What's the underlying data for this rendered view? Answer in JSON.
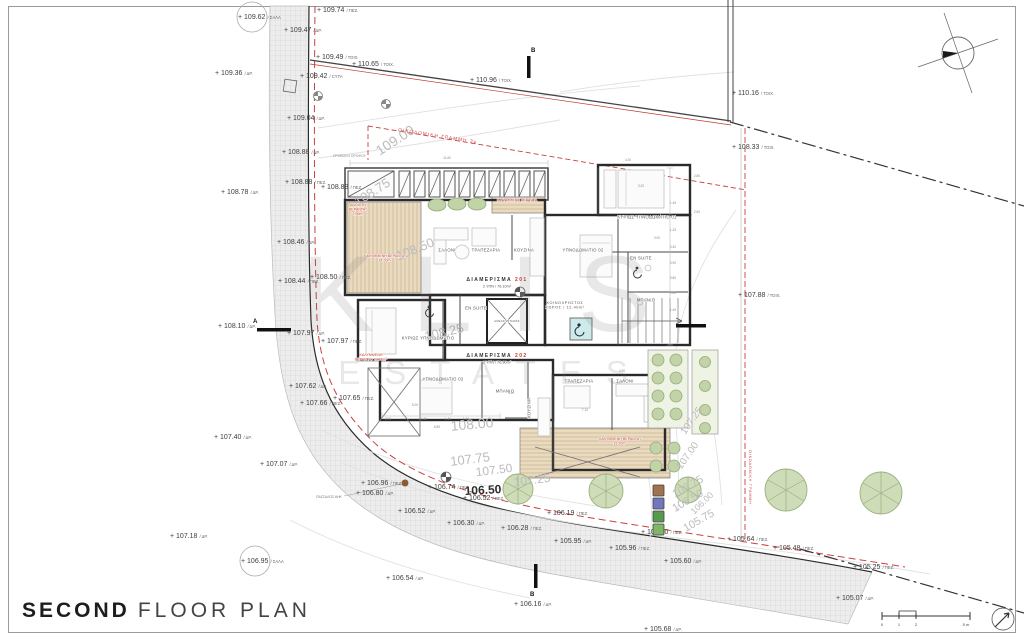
{
  "title": {
    "bold": "SECOND",
    "rest": "FLOOR PLAN"
  },
  "watermark": {
    "line1": "KLIS",
    "line2": "ESTATES"
  },
  "site_labels": {
    "building_line_top": "ΟΙΚΟΔΟΜΙΚΗ ΓΡΑΜΜΗ 3μ",
    "building_line_right": "ΟΙΚΟΔΟΜΙΚΗ ΓΡΑΜΜΗ",
    "floor_projection": "ΠΡΟΒΟΛΗ ΟΡΟΦΟΥ",
    "pole": "ΠΑΣΣΑΛΟΣ ΑΗΚ"
  },
  "apartments": [
    {
      "name": "ΔΙΑΜΕΡΙΣΜΑ",
      "number": "201",
      "info": "2 ΥΠΝ / 76.10m²",
      "x": 497,
      "y": 281
    },
    {
      "name": "ΔΙΑΜΕΡΙΣΜΑ",
      "number": "202",
      "info": "2 ΥΠΝ / 76.80m²",
      "x": 497,
      "y": 357
    }
  ],
  "common_area": {
    "lines": [
      "ΚΟΙΝΟΧΡΗΣΤΟΣ",
      "ΧΩΡΟΣ / 12.40m²"
    ],
    "x": 565,
    "y": 304
  },
  "rooms": [
    {
      "label": "ΣΑΛΟΝΙ",
      "x": 447,
      "y": 250
    },
    {
      "label": "ΤΡΑΠΕΖΑΡΙΑ",
      "x": 486,
      "y": 250
    },
    {
      "label": "ΚΟΥΖΙΝΑ",
      "x": 524,
      "y": 250
    },
    {
      "label": "ΥΠΝΟΔΩΜΑΤΙΟ 02",
      "x": 583,
      "y": 250
    },
    {
      "label": "ΚΥΡΙΩΣ ΥΠΝΟΔΩΜΑΤΙΟ 01",
      "x": 647,
      "y": 217
    },
    {
      "label": "EN SUITE",
      "x": 641,
      "y": 258
    },
    {
      "label": "ΜΠΑΝΙΟ",
      "x": 646,
      "y": 300
    },
    {
      "label": "EN SUITE",
      "x": 476,
      "y": 308
    },
    {
      "label": "ΑΝΕΛΚΥΣΤΗΡΑΣ",
      "x": 507,
      "y": 321,
      "size": 2.8
    },
    {
      "label": "ΚΥΡΙΩΣ ΥΠΝΟΔΩΜΑΤΙΟ",
      "x": 428,
      "y": 338
    },
    {
      "label": "ΥΠΝΟΔΩΜΑΤΙΟ 02",
      "x": 443,
      "y": 379
    },
    {
      "label": "ΜΠΑΝΙΟ",
      "x": 505,
      "y": 391
    },
    {
      "label": "ΚΟΥΖΙΝΑ",
      "x": 529,
      "y": 408,
      "rot": -90
    },
    {
      "label": "ΤΡΑΠΕΖΑΡΙΑ",
      "x": 579,
      "y": 381
    },
    {
      "label": "ΣΑΛΟΝΙ",
      "x": 625,
      "y": 381
    }
  ],
  "red_areas": [
    {
      "lines": [
        "ΑΝΟΙΧΤΗ",
        "ΒΕΡΑΝΤΑ /",
        "7.90m²"
      ],
      "x": 358,
      "y": 206
    },
    {
      "lines": [
        "ΚΑΛΥΜΜΕΝΗ ΒΕΡΑΝΤΑ /",
        "14.20m²"
      ],
      "x": 385,
      "y": 257
    },
    {
      "lines": [
        "ΚΑΛΥΜΜΕΝΗ ΒΕΡΑΝΤΑ"
      ],
      "x": 517,
      "y": 201
    },
    {
      "lines": [
        "ΚΑΛΥΜΜΕΝΗ",
        "ΒΕΡΑΝΤΑ / 21.60m²"
      ],
      "x": 371,
      "y": 356
    },
    {
      "lines": [
        "ΚΑΛΥΜΜΕΝΗ ΒΕΡΑΝΤΑ /",
        "19.20m²"
      ],
      "x": 620,
      "y": 440
    }
  ],
  "elevations": [
    {
      "v": "+ 109.62",
      "s": "ΣΑΛΑ",
      "x": 238,
      "y": 17,
      "circle": true
    },
    {
      "v": "+ 109.74",
      "s": "ΠΕΖ.",
      "x": 317,
      "y": 10
    },
    {
      "v": "+ 109.47",
      "s": "ΔΡ.",
      "x": 284,
      "y": 30
    },
    {
      "v": "+ 109.49",
      "s": "ΤΟΙΧ.",
      "x": 316,
      "y": 57
    },
    {
      "v": "+ 110.65",
      "s": "ΤΟΙΧ.",
      "x": 352,
      "y": 64
    },
    {
      "v": "+ 109.36",
      "s": "ΔΡ.",
      "x": 215,
      "y": 73
    },
    {
      "v": "+ 109.42",
      "s": "CYTA",
      "x": 300,
      "y": 76
    },
    {
      "v": "+ 110.96",
      "s": "ΤΟΙΧ.",
      "x": 470,
      "y": 80
    },
    {
      "v": "+ 110.16",
      "s": "ΤΟΙΧ.",
      "x": 732,
      "y": 93
    },
    {
      "v": "+ 109.04",
      "s": "ΔΡ.",
      "x": 287,
      "y": 118
    },
    {
      "v": "+ 108.33",
      "s": "ΤΟΙΧ.",
      "x": 732,
      "y": 147
    },
    {
      "v": "+ 108.88",
      "s": "ΔΡ.",
      "x": 282,
      "y": 152
    },
    {
      "v": "+ 108.88",
      "s": "ΠΕΖ.",
      "x": 285,
      "y": 182
    },
    {
      "v": "+ 108.88",
      "s": "ΠΕΖ.",
      "x": 321,
      "y": 187
    },
    {
      "v": "+ 108.78",
      "s": "ΔΡ.",
      "x": 221,
      "y": 192
    },
    {
      "v": "+ 108.46",
      "s": "ΔΡ.",
      "x": 277,
      "y": 242
    },
    {
      "v": "+ 108.50",
      "s": "ΠΕΖ.",
      "x": 310,
      "y": 277
    },
    {
      "v": "+ 108.44",
      "s": "ΠΕΖ.",
      "x": 278,
      "y": 281
    },
    {
      "v": "+ 107.88",
      "s": "ΤΟΙΧ.",
      "x": 738,
      "y": 295
    },
    {
      "v": "+ 108.10",
      "s": "ΔΡ.",
      "x": 218,
      "y": 326
    },
    {
      "v": "+ 107.97",
      "s": "ΔΡ.",
      "x": 287,
      "y": 333
    },
    {
      "v": "+ 107.97",
      "s": "ΠΕΖ.",
      "x": 321,
      "y": 341
    },
    {
      "v": "+ 107.62",
      "s": "ΔΡ.",
      "x": 289,
      "y": 386
    },
    {
      "v": "+ 107.65",
      "s": "ΠΕΖ.",
      "x": 333,
      "y": 398
    },
    {
      "v": "+ 107.66",
      "s": "ΠΕΖ.",
      "x": 300,
      "y": 403
    },
    {
      "v": "+ 107.40",
      "s": "ΔΡ.",
      "x": 214,
      "y": 437
    },
    {
      "v": "+ 107.07",
      "s": "ΔΡ.",
      "x": 260,
      "y": 464
    },
    {
      "v": "+ 106.96",
      "s": "ΠΕΖ.",
      "x": 361,
      "y": 483
    },
    {
      "v": "+ 106.80",
      "s": "ΔΡ.",
      "x": 356,
      "y": 493
    },
    {
      "v": "+ 106.74",
      "s": "ΠΕΖ.",
      "x": 428,
      "y": 487
    },
    {
      "v": "+ 106.52",
      "s": "ΠΕΖ.",
      "x": 463,
      "y": 498
    },
    {
      "v": "+ 106.52",
      "s": "ΔΡ.",
      "x": 398,
      "y": 511
    },
    {
      "v": "+ 106.30",
      "s": "ΔΡ.",
      "x": 447,
      "y": 523
    },
    {
      "v": "+ 106.28",
      "s": "ΠΕΖ.",
      "x": 501,
      "y": 528
    },
    {
      "v": "+ 106.19",
      "s": "ΠΕΖ.",
      "x": 547,
      "y": 513
    },
    {
      "v": "+ 107.18",
      "s": "ΔΡ.",
      "x": 170,
      "y": 536
    },
    {
      "v": "+ 106.95",
      "s": "ΣΑΛΑ",
      "x": 241,
      "y": 561,
      "circle": true
    },
    {
      "v": "+ 105.95",
      "s": "ΔΡ.",
      "x": 554,
      "y": 541
    },
    {
      "v": "+ 105.96",
      "s": "ΠΕΖ.",
      "x": 609,
      "y": 548
    },
    {
      "v": "+ 105.90",
      "s": "ΠΕΖ.",
      "x": 641,
      "y": 532
    },
    {
      "v": "+ 106.54",
      "s": "ΔΡ.",
      "x": 386,
      "y": 578
    },
    {
      "v": "+ 105.60",
      "s": "ΔΡ.",
      "x": 664,
      "y": 561
    },
    {
      "v": "+ 105.64",
      "s": "ΠΕΖ.",
      "x": 727,
      "y": 539
    },
    {
      "v": "+ 105.48",
      "s": "ΠΕΖ.",
      "x": 773,
      "y": 548
    },
    {
      "v": "+ 105.25",
      "s": "ΠΕΖ.",
      "x": 853,
      "y": 567
    },
    {
      "v": "+ 105.07",
      "s": "ΔΡ.",
      "x": 836,
      "y": 598
    },
    {
      "v": "+ 106.16",
      "s": "ΔΡ.",
      "x": 514,
      "y": 604
    },
    {
      "v": "+ 105.68",
      "s": "ΔΡ.",
      "x": 644,
      "y": 629
    }
  ],
  "contours": [
    {
      "t": "109.00",
      "x": 395,
      "y": 140,
      "r": -33,
      "fs": 14
    },
    {
      "t": "108.75",
      "x": 372,
      "y": 192,
      "r": -33,
      "fs": 13
    },
    {
      "t": "108.50",
      "x": 415,
      "y": 249,
      "r": -22,
      "fs": 13
    },
    {
      "t": "108.25",
      "x": 444,
      "y": 332,
      "r": -13,
      "fs": 13
    },
    {
      "t": "108.00",
      "x": 472,
      "y": 424,
      "r": -5,
      "fs": 14
    },
    {
      "t": "107.75",
      "x": 470,
      "y": 459,
      "r": -7,
      "fs": 13
    },
    {
      "t": "107.50",
      "x": 494,
      "y": 470,
      "r": -7,
      "fs": 12
    },
    {
      "t": "107.25",
      "x": 532,
      "y": 480,
      "r": -7,
      "fs": 12
    },
    {
      "t": "106.50",
      "x": 483,
      "y": 490,
      "r": -3,
      "fs": 12,
      "bold": true
    },
    {
      "t": "107.25",
      "x": 692,
      "y": 421,
      "r": -55,
      "fs": 10
    },
    {
      "t": "107.00",
      "x": 688,
      "y": 456,
      "r": -55,
      "fs": 10
    },
    {
      "t": "106.75",
      "x": 688,
      "y": 487,
      "r": -30,
      "fs": 11
    },
    {
      "t": "106.50",
      "x": 688,
      "y": 501,
      "r": -30,
      "fs": 11
    },
    {
      "t": "106.00",
      "x": 702,
      "y": 503,
      "r": -44,
      "fs": 9
    },
    {
      "t": "105.75",
      "x": 699,
      "y": 521,
      "r": -30,
      "fs": 11
    }
  ],
  "dims": [
    {
      "t": "11.60",
      "x": 447,
      "y": 158
    },
    {
      "t": "4.30",
      "x": 628,
      "y": 160
    },
    {
      "t": "2.80",
      "x": 697,
      "y": 176
    },
    {
      "t": "2.60",
      "x": 697,
      "y": 212
    },
    {
      "t": "3.20",
      "x": 641,
      "y": 186
    },
    {
      "t": "3.00",
      "x": 657,
      "y": 238
    },
    {
      "t": "1.45",
      "x": 673,
      "y": 203
    },
    {
      "t": "1.25",
      "x": 673,
      "y": 230
    },
    {
      "t": "0.40",
      "x": 673,
      "y": 247
    },
    {
      "t": "0.90",
      "x": 673,
      "y": 263
    },
    {
      "t": "0.80",
      "x": 673,
      "y": 278
    },
    {
      "t": "2.00",
      "x": 673,
      "y": 293
    },
    {
      "t": "1.45",
      "x": 673,
      "y": 310
    },
    {
      "t": "5.00",
      "x": 415,
      "y": 405
    },
    {
      "t": "3.10",
      "x": 511,
      "y": 393
    },
    {
      "t": "2.00",
      "x": 388,
      "y": 419
    },
    {
      "t": "1.80",
      "x": 424,
      "y": 419
    },
    {
      "t": "1.40",
      "x": 448,
      "y": 419
    },
    {
      "t": "1.30",
      "x": 466,
      "y": 419
    },
    {
      "t": "6.80",
      "x": 437,
      "y": 427
    },
    {
      "t": "7.10",
      "x": 585,
      "y": 410
    },
    {
      "t": "4.90",
      "x": 622,
      "y": 371
    }
  ],
  "legend_colors": [
    "#a1724f",
    "#7277bd",
    "#579a4e",
    "#7fb765"
  ],
  "scale_bar": {
    "labels": [
      "0",
      "1",
      "2",
      "5 m"
    ],
    "xs": [
      882,
      899,
      916,
      966
    ]
  },
  "sections": [
    {
      "letter": "A",
      "x": 253,
      "y": 323
    },
    {
      "letter": "B",
      "x": 531,
      "y": 52
    },
    {
      "letter": "B",
      "x": 530,
      "y": 596
    }
  ]
}
